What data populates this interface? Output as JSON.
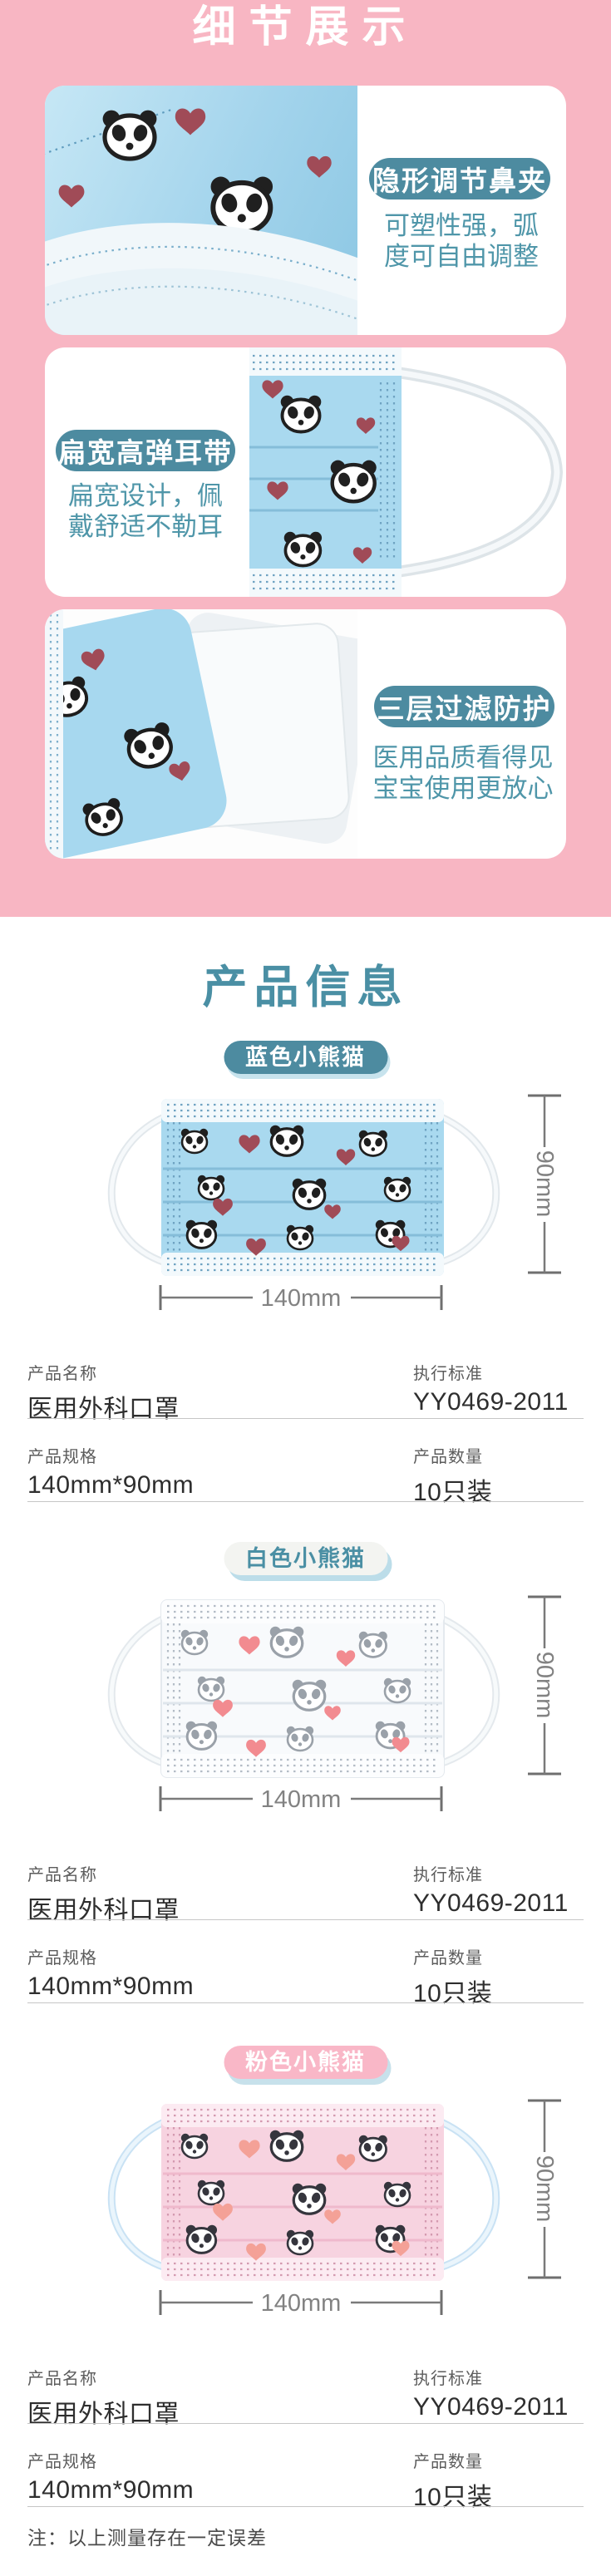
{
  "detail": {
    "title": "细节展示",
    "cards": [
      {
        "badge": "隐形调节鼻夹",
        "desc": [
          "可塑性强，弧",
          "度可自由调整"
        ]
      },
      {
        "badge": "扁宽高弹耳带",
        "desc": [
          "扁宽设计，佩",
          "戴舒适不勒耳"
        ]
      },
      {
        "badge": "三层过滤防护",
        "desc": [
          "医用品质看得见",
          "宝宝使用更放心"
        ]
      }
    ]
  },
  "products": {
    "title": "产品信息",
    "dimensions": {
      "width": "140mm",
      "height": "90mm"
    },
    "variants": [
      {
        "badge": "蓝色小熊猫",
        "color_theme": "blue",
        "mask_color": "#a9d9ef",
        "badge_bg": "#4d8ba0",
        "badge_text_color": "#ffffff"
      },
      {
        "badge": "白色小熊猫",
        "color_theme": "white",
        "mask_color": "#f8fafc",
        "badge_bg": "#f3f4f1",
        "badge_text_color": "#4a8fa4"
      },
      {
        "badge": "粉色小熊猫",
        "color_theme": "pink",
        "mask_color": "#f7d3e0",
        "badge_bg": "#f9b7c7",
        "badge_text_color": "#ffffff"
      }
    ],
    "spec_table": {
      "name_label": "产品名称",
      "name_value": "医用外科口罩",
      "standard_label": "执行标准",
      "standard_value": "YY0469-2011",
      "spec_label": "产品规格",
      "spec_value": "140mm*90mm",
      "qty_label": "产品数量",
      "qty_value": "10只装"
    }
  },
  "note": "注：以上测量存在一定误差",
  "colors": {
    "pink_background": "#f8b6c3",
    "teal_badge": "#4d8ba0",
    "teal_text": "#4f96a9",
    "section_title_teal": "#4a8fa4",
    "dimension_gray": "#7a7a7a",
    "heart_dark_red": "#a04b57",
    "heart_salmon": "#f28b90"
  }
}
